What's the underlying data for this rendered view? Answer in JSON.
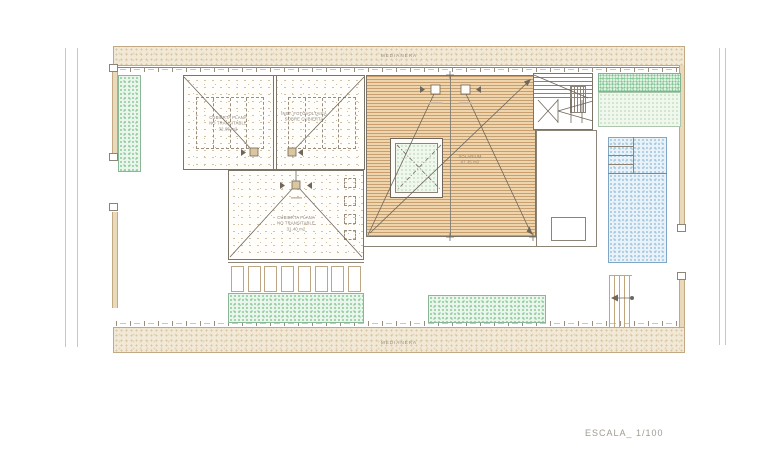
{
  "drawing": {
    "scale_label": "ESCALA_ 1/100",
    "party_wall": {
      "top": "MEDIANERA",
      "bottom": "MEDIANERA"
    },
    "areas": {
      "roof_left": {
        "line1": "CUBIERTA PLANA",
        "line2": "NO TRANSITABLE",
        "area": "32.06 m2"
      },
      "roof_pv": {
        "line1": "INST. FOTOVOLTAICA",
        "line2": "SOBRE CUBIERTA"
      },
      "roof_lower": {
        "line1": "CUBIERTA PLANA",
        "line2": "NO TRANSITABLE",
        "area": "31.40 m2"
      },
      "solarium": {
        "name": "SOLARIUM",
        "area": "47.35 m2"
      }
    },
    "colors": {
      "deck_wood": "#eed5ad",
      "deck_line": "#c89f6c",
      "pool_water": "#e9f2f9",
      "lawn_green": "#bfe3c8",
      "sand_hatch": "#f1e8d5",
      "drawing_line": "#6f675c"
    }
  }
}
